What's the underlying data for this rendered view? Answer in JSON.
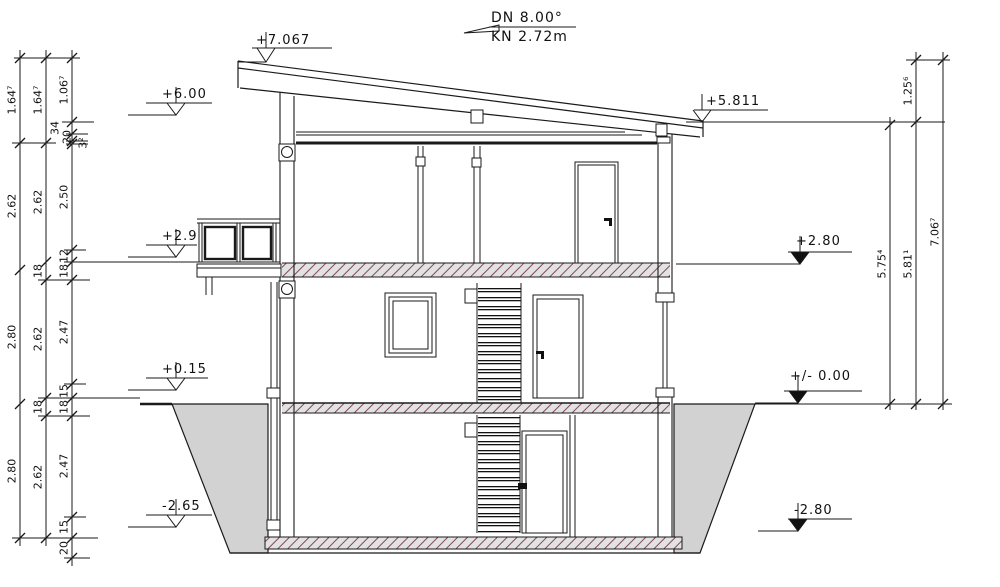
{
  "annotation": {
    "dn": "DN 8.00°",
    "kn": "KN 2.72m"
  },
  "colors": {
    "line": "#1a1a1a",
    "earth_fill": "#d2d2d2",
    "slab_fill": "#e2e2e2",
    "hatch_stroke": "#80485c"
  },
  "levels": [
    {
      "label": "+7.067",
      "tx": 256,
      "ty": 33,
      "ux1": 252,
      "ux2": 332,
      "uy": 48,
      "cx": 266,
      "fill": false,
      "lx1": 238,
      "lx2": 266,
      "ly": 62
    },
    {
      "label": "+6.00",
      "tx": 162,
      "ty": 87,
      "ux1": 146,
      "ux2": 212,
      "uy": 103,
      "cx": 176,
      "fill": false,
      "lx1": 128,
      "lx2": 176,
      "ly": 115
    },
    {
      "label": "+2.9",
      "tx": 162,
      "ty": 229,
      "ux1": 146,
      "ux2": 197,
      "uy": 245,
      "cx": 176,
      "fill": false,
      "lx1": 128,
      "lx2": 176,
      "ly": 257
    },
    {
      "label": "+0.15",
      "tx": 162,
      "ty": 362,
      "ux1": 146,
      "ux2": 208,
      "uy": 378,
      "cx": 176,
      "fill": false,
      "lx1": 128,
      "lx2": 176,
      "ly": 390
    },
    {
      "label": "-2.65",
      "tx": 162,
      "ty": 499,
      "ux1": 146,
      "ux2": 212,
      "uy": 515,
      "cx": 176,
      "fill": false,
      "lx1": 128,
      "lx2": 176,
      "ly": 527
    },
    {
      "label": "+5.811",
      "tx": 706,
      "ty": 94,
      "ux1": 694,
      "ux2": 768,
      "uy": 110,
      "cx": 702,
      "fill": false,
      "lx1": 686,
      "lx2": 945,
      "ly": 122
    },
    {
      "label": "+2.80",
      "tx": 796,
      "ty": 234,
      "ux1": 788,
      "ux2": 852,
      "uy": 252,
      "cx": 800,
      "fill": true,
      "lx1": 676,
      "lx2": 800,
      "ly": 264
    },
    {
      "label": "+/- 0.00",
      "tx": 790,
      "ty": 369,
      "ux1": 784,
      "ux2": 862,
      "uy": 391,
      "cx": 798,
      "fill": true,
      "lx1": 755,
      "lx2": 798,
      "ly": 403
    },
    {
      "label": "-2.80",
      "tx": 794,
      "ty": 503,
      "ux1": 788,
      "ux2": 852,
      "uy": 519,
      "cx": 798,
      "fill": true,
      "lx1": 758,
      "lx2": 798,
      "ly": 531
    }
  ],
  "chains": [
    {
      "x": 20,
      "y1": 50,
      "y2": 546,
      "boundaries": [
        58,
        143,
        270,
        404,
        538
      ],
      "segments": [
        {
          "label": "1.64⁷",
          "y": 100
        },
        {
          "label": "2.62",
          "y": 206
        },
        {
          "label": "2.80",
          "y": 337
        },
        {
          "label": "2.80",
          "y": 471
        }
      ]
    },
    {
      "x": 46,
      "y1": 50,
      "y2": 546,
      "boundaries": [
        58,
        143,
        262,
        280,
        398,
        416,
        538
      ],
      "segments": [
        {
          "label": "1.64⁷",
          "y": 100
        },
        {
          "label": "2.62",
          "y": 202
        },
        {
          "label": "18",
          "y": 271
        },
        {
          "label": "2.62",
          "y": 339
        },
        {
          "label": "18",
          "y": 407
        },
        {
          "label": "2.62",
          "y": 477
        }
      ]
    },
    {
      "x": 72,
      "y1": 50,
      "y2": 566,
      "boundaries": [
        58,
        122,
        134,
        141,
        144,
        250,
        262,
        280,
        384,
        398,
        416,
        517,
        538,
        558
      ],
      "segments": [
        {
          "label": "1.06⁷",
          "y": 90
        },
        {
          "label": "34",
          "y": 128,
          "dx": -17
        },
        {
          "label": "20",
          "y": 137,
          "dx": -5
        },
        {
          "label": "3²",
          "y": 143,
          "dx": 11
        },
        {
          "label": "2.50",
          "y": 197
        },
        {
          "label": "12",
          "y": 256
        },
        {
          "label": "18",
          "y": 271
        },
        {
          "label": "2.47",
          "y": 332
        },
        {
          "label": "15",
          "y": 391
        },
        {
          "label": "18",
          "y": 407
        },
        {
          "label": "2.47",
          "y": 466
        },
        {
          "label": "15",
          "y": 527
        },
        {
          "label": "20",
          "y": 548
        }
      ]
    },
    {
      "x": 890,
      "y1": 117,
      "y2": 410,
      "boundaries": [
        125,
        404
      ],
      "segments": [
        {
          "label": "5.75⁴",
          "y": 264
        }
      ]
    },
    {
      "x": 916,
      "y1": 52,
      "y2": 410,
      "boundaries": [
        60,
        122,
        404
      ],
      "segments": [
        {
          "label": "1.25⁶",
          "y": 91
        },
        {
          "label": "5.81¹",
          "y": 264
        }
      ]
    },
    {
      "x": 943,
      "y1": 52,
      "y2": 410,
      "boundaries": [
        60,
        404
      ],
      "segments": [
        {
          "label": "7.06⁷",
          "y": 232
        }
      ]
    }
  ],
  "ext_lines": [
    [
      58,
      14,
      80,
      1
    ],
    [
      122,
      62,
      94,
      1
    ],
    [
      134,
      66,
      88,
      1
    ],
    [
      141,
      66,
      88,
      1
    ],
    [
      144,
      66,
      88,
      1
    ],
    [
      143,
      12,
      56,
      1
    ],
    [
      250,
      64,
      86,
      1
    ],
    [
      262,
      64,
      197,
      1
    ],
    [
      280,
      38,
      90,
      1
    ],
    [
      384,
      64,
      86,
      1
    ],
    [
      398,
      38,
      140,
      1
    ],
    [
      404,
      140,
      172,
      2.5
    ],
    [
      416,
      38,
      90,
      1
    ],
    [
      517,
      64,
      86,
      1
    ],
    [
      538,
      12,
      98,
      1
    ],
    [
      558,
      64,
      90,
      1
    ],
    [
      60,
      906,
      950,
      1
    ],
    [
      404,
      755,
      952,
      1
    ]
  ]
}
